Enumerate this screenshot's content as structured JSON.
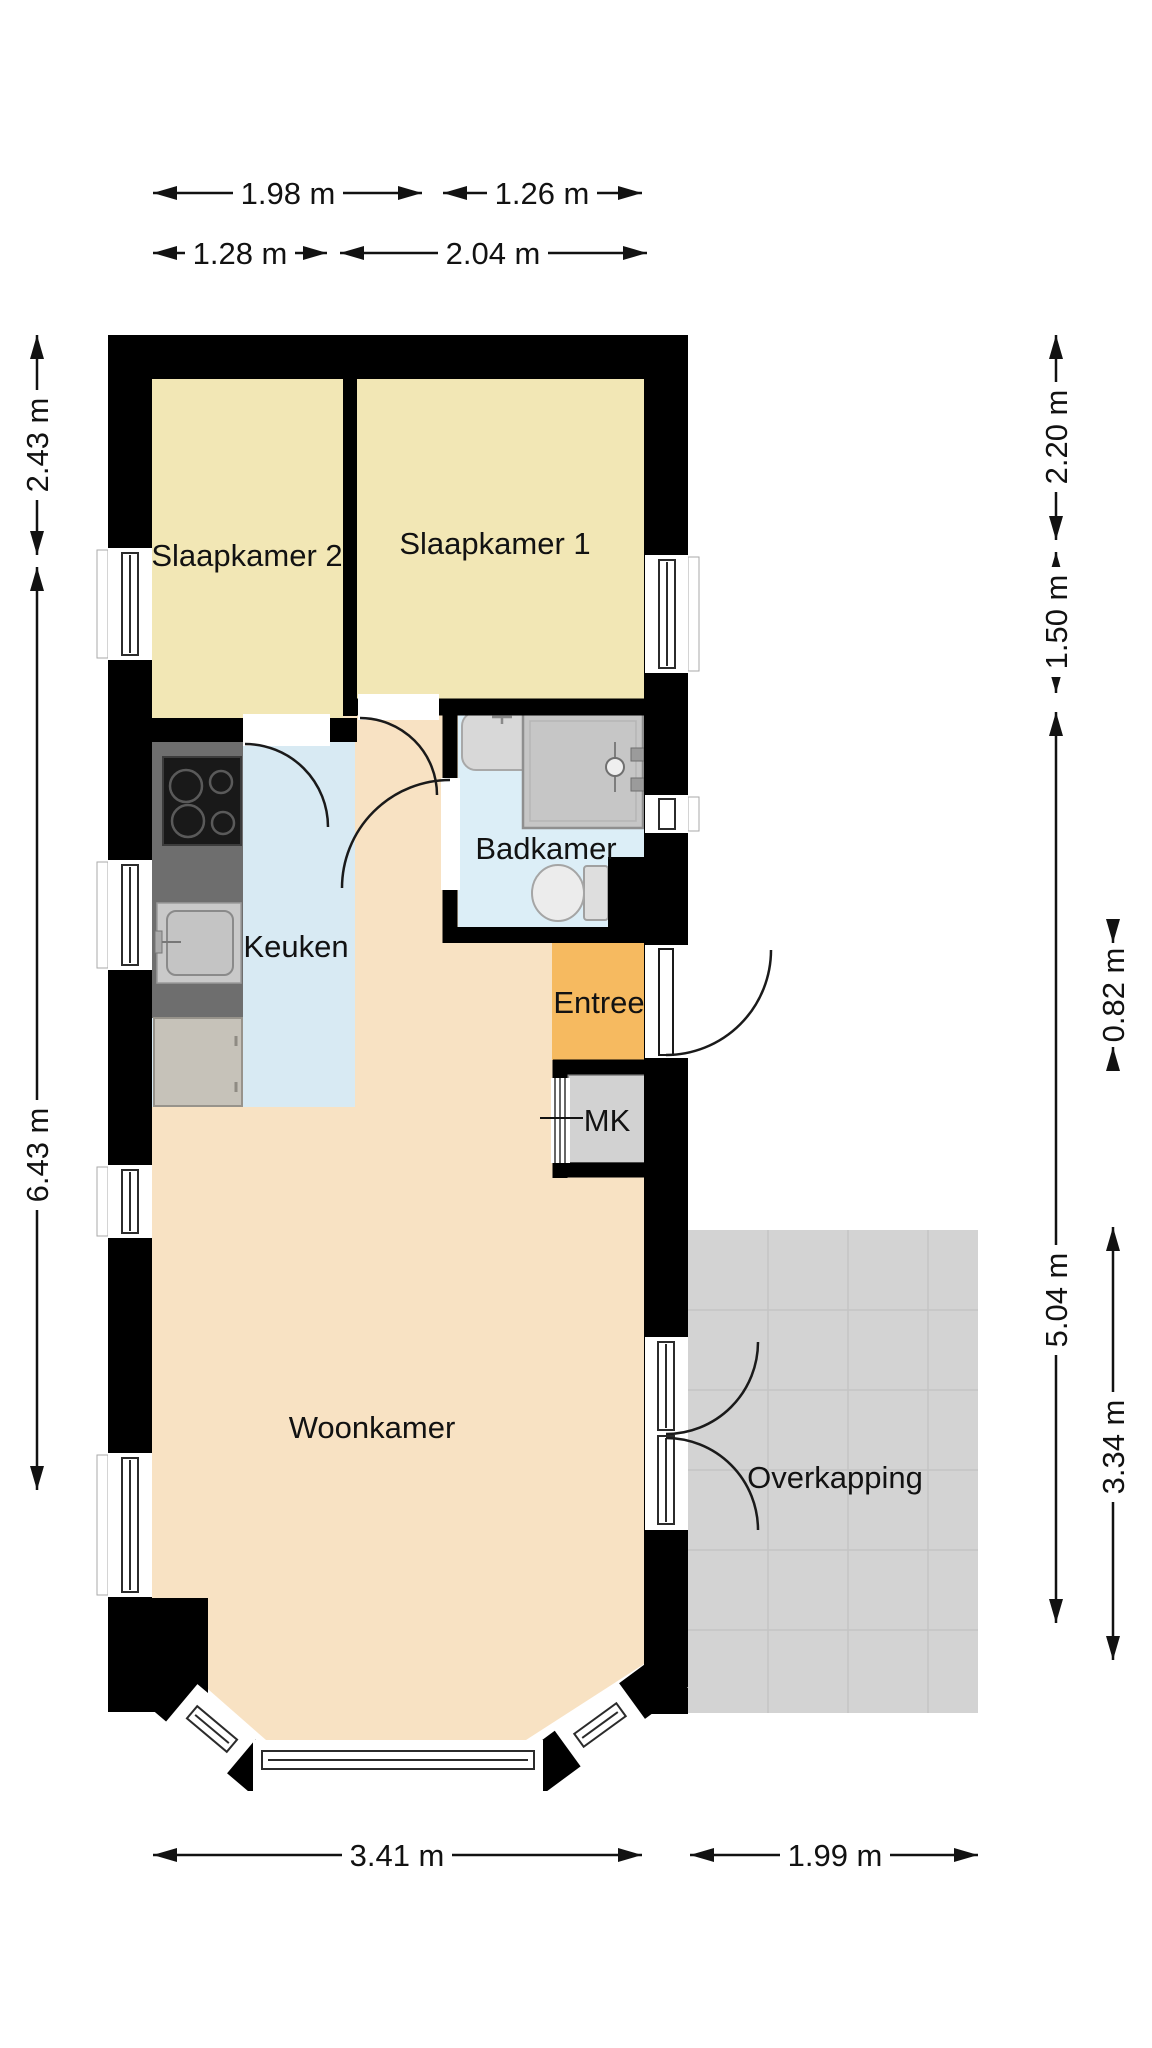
{
  "plan": {
    "title": "Plattegrond begane grond",
    "rooms": {
      "slaapkamer2": {
        "label": "Slaapkamer 2"
      },
      "slaapkamer1": {
        "label": "Slaapkamer 1"
      },
      "badkamer": {
        "label": "Badkamer"
      },
      "keuken": {
        "label": "Keuken"
      },
      "entree": {
        "label": "Entree"
      },
      "mk": {
        "label": "MK"
      },
      "woonkamer": {
        "label": "Woonkamer"
      },
      "overkapping": {
        "label": "Overkapping"
      }
    },
    "dimensions": {
      "top_row1_left": "1.98 m",
      "top_row1_right": "1.26 m",
      "top_row2_left": "1.28 m",
      "top_row2_right": "2.04 m",
      "left_upper": "2.43 m",
      "left_lower": "6.43 m",
      "right_inner_upper": "2.20 m",
      "right_inner_mid": "1.50 m",
      "right_inner_lower": "5.04 m",
      "right_outer_small": "0.82 m",
      "right_outer_lower": "3.34 m",
      "bottom_left": "3.41 m",
      "bottom_right": "1.99 m"
    },
    "colors": {
      "wall": "#000000",
      "bedroom_floor": "#f2e7b5",
      "kitchen_floor": "#d8eaf3",
      "bathroom_floor": "#dceef7",
      "entry_floor": "#f6ba60",
      "living_floor": "#f8e2c3",
      "canopy_floor": "#d3d3d3",
      "closet_floor": "#d2d2d2",
      "dimension_ink": "#121212"
    }
  }
}
